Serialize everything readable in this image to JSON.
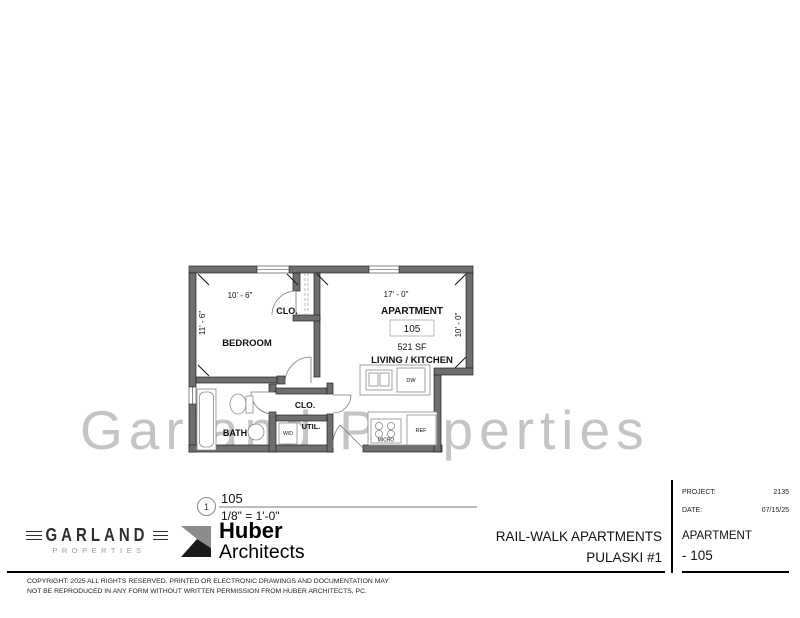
{
  "watermark": "Garland Properties",
  "plan": {
    "dims": {
      "width_left": "10' - 6\"",
      "width_right": "17' - 0\"",
      "height_left": "11' - 6\"",
      "height_right": "10' - 0\""
    },
    "labels": {
      "bedroom": "BEDROOM",
      "closet_top": "CLO.",
      "apartment": "APARTMENT",
      "unit_number": "105",
      "area": "521 SF",
      "living_kitchen": "LIVING / KITCHEN",
      "closet_mid": "CLO.",
      "bath": "BATH",
      "util": "UTIL.",
      "washer_dryer": "W/D",
      "dishwasher": "DW",
      "microwave": "MICRO",
      "refrigerator": "REF"
    }
  },
  "view_title": {
    "number": "1",
    "name": "105",
    "scale": "1/8\" = 1'-0\""
  },
  "branding": {
    "garland": {
      "name": "GARLAND",
      "tagline": "PROPERTIES"
    },
    "huber": {
      "line1": "Huber",
      "line2": "Architects"
    }
  },
  "title_block": {
    "project_name_line1": "RAIL-WALK APARTMENTS",
    "project_name_line2": "PULASKI #1",
    "project_label": "PROJECT:",
    "project_number": "2135",
    "date_label": "DATE:",
    "date_value": "07/15/25",
    "sheet_label": "APARTMENT",
    "sheet_number": "- 105"
  },
  "copyright": {
    "line1": "COPYRIGHT: 2025 ALL RIGHTS RESERVED.  PRINTED OR ELECTRONIC DRAWINGS AND DOCUMENTATION MAY",
    "line2": "NOT BE REPRODUCED IN ANY FORM WITHOUT WRITTEN PERMISSION FROM HUBER ARCHITECTS, PC."
  },
  "colors": {
    "wall": "#6e6e6e",
    "wall_line": "#222222",
    "watermark": "#c4c4c4"
  }
}
